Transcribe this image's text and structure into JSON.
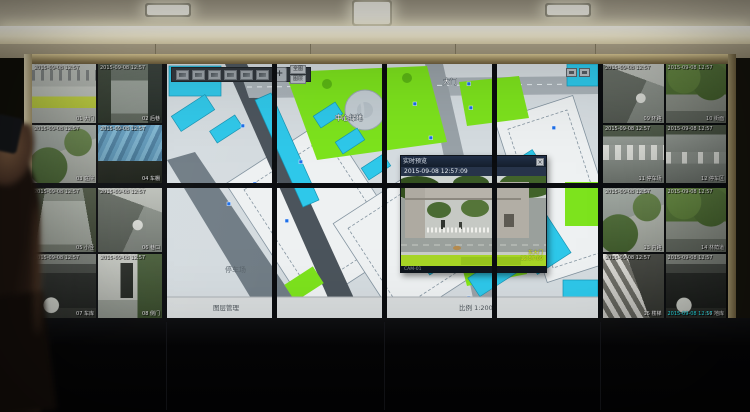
{
  "colors": {
    "map_cyan": "#2ec8ea",
    "map_green": "#7de31d",
    "map_road_dark": "#4b545c",
    "map_background": "#d5dce0",
    "popup_titlebar": "#141e2c",
    "frame_gold": "#b3a170",
    "bezel": "#0b0d10",
    "osd_green": "#d8e820"
  },
  "ceiling": {
    "recessed_light_count": 3
  },
  "map": {
    "toolbar": {
      "icons": [
        "pointer-tool",
        "pan-tool",
        "zoom-in-tool",
        "zoom-out-tool",
        "measure-tool",
        "layer-tool"
      ],
      "text_buttons": [
        "全图",
        "图层"
      ],
      "corner_icons": [
        "overview",
        "fullscreen"
      ]
    },
    "labels": [
      {
        "text": "大门",
        "x": 276,
        "y": 20,
        "dark": false
      },
      {
        "text": "中心绿地",
        "x": 168,
        "y": 56,
        "dark": false
      },
      {
        "text": "综合楼",
        "x": 288,
        "y": 170,
        "dark": false
      },
      {
        "text": "停车场",
        "x": 58,
        "y": 208,
        "dark": true
      }
    ],
    "camera_markers": [
      [
        74,
        60
      ],
      [
        86,
        118
      ],
      [
        60,
        138
      ],
      [
        118,
        155
      ],
      [
        132,
        96
      ],
      [
        246,
        38
      ],
      [
        262,
        72
      ],
      [
        288,
        95
      ],
      [
        302,
        42
      ],
      [
        256,
        128
      ],
      [
        312,
        152
      ],
      [
        240,
        188
      ],
      [
        332,
        205
      ],
      [
        300,
        232
      ],
      [
        385,
        62
      ],
      [
        342,
        130
      ],
      [
        300,
        18
      ]
    ],
    "status_bar": {
      "left": "图层管理",
      "right": "比例 1:2000"
    }
  },
  "popup": {
    "title": "实时预览",
    "close_label": "×",
    "timestamp": "2015-09-08 12:57:09",
    "video_osd": [
      "东大门",
      "12:57:09"
    ],
    "footer": "CAM-01"
  },
  "camera_tiles": {
    "osd_time": "2015-09-08 12:57",
    "left": [
      {
        "scene": "lawnfront",
        "name": "01 大门"
      },
      {
        "scene": "alley",
        "name": "02 后巷"
      },
      {
        "scene": "courtyard",
        "name": "03 庭院"
      },
      {
        "scene": "canopy",
        "name": "04 车棚"
      },
      {
        "scene": "path",
        "name": "05 小径"
      },
      {
        "scene": "street",
        "name": "06 巷口"
      },
      {
        "scene": "garage",
        "name": "07 车库"
      },
      {
        "scene": "gatehouse",
        "name": "08 侧门"
      }
    ],
    "right": [
      {
        "scene": "street",
        "name": "09 环路"
      },
      {
        "scene": "treeline",
        "name": "10 街面"
      },
      {
        "scene": "parking",
        "name": "11 停车场"
      },
      {
        "scene": "parking2",
        "name": "12 停车区"
      },
      {
        "scene": "courtyard",
        "name": "13 内路"
      },
      {
        "scene": "treeline",
        "name": "14 林荫道"
      },
      {
        "scene": "stairs",
        "name": "15 楼梯"
      },
      {
        "scene": "garage",
        "name": "16 地库",
        "cyan": true
      }
    ]
  }
}
